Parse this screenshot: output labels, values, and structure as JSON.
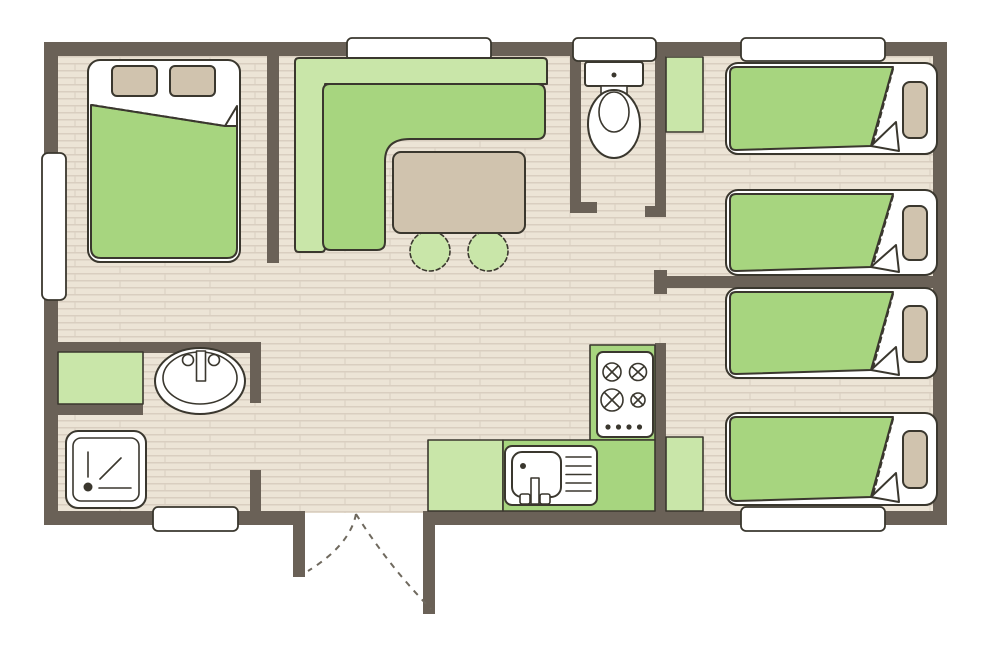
{
  "type": "mobile-home-floor-plan",
  "colors": {
    "wall": "#6a6157",
    "floor_base": "#ece4d6",
    "floor_line": "#d9cec0",
    "outline": "#3a372e",
    "green": "#a7d57f",
    "light_green": "#c9e6a9",
    "tan": "#d0c3ae",
    "white": "#ffffff",
    "door_dash": "#6f695e"
  },
  "fixtures": {
    "double_bed": 1,
    "single_beds": 4,
    "corner_sofa": 1,
    "dining_table": 1,
    "stools": 2,
    "toilet": 1,
    "washbasin": 1,
    "shower": 1,
    "hob_burners": 4,
    "kitchen_sink": 1,
    "cabinets": 3,
    "windows": 6,
    "entrance_double_door": 1
  }
}
